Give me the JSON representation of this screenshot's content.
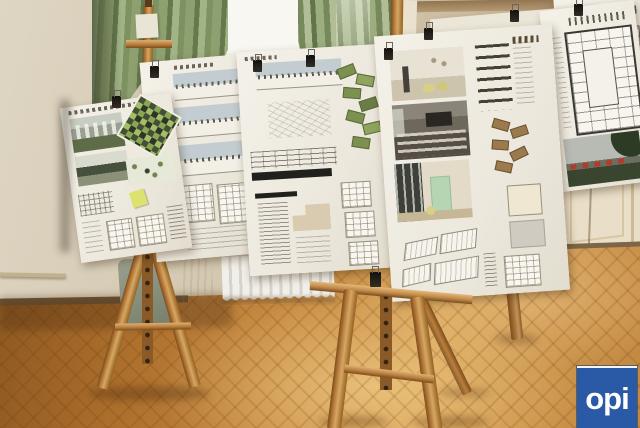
{
  "photo": {
    "subject": "Architectural competition presentation boards displayed on wooden easels in a classical room with green curtains and parquet floor",
    "watermark": {
      "text": "opi"
    },
    "counts": {
      "easels": 3,
      "presentation_boards": 8
    },
    "colors": {
      "watermark_blue": "#2a5aa6",
      "curtain_green": "#8da06e",
      "wall_beige": "#d2c7af",
      "easel_wood": "#b97f3e",
      "floor_wood": "#c9924d",
      "board_white": "#f1eee6",
      "site_plan_green": "#8aa554",
      "door_render_mint": "#b5d6b2",
      "photo_accent_red": "#b23c2c"
    }
  }
}
